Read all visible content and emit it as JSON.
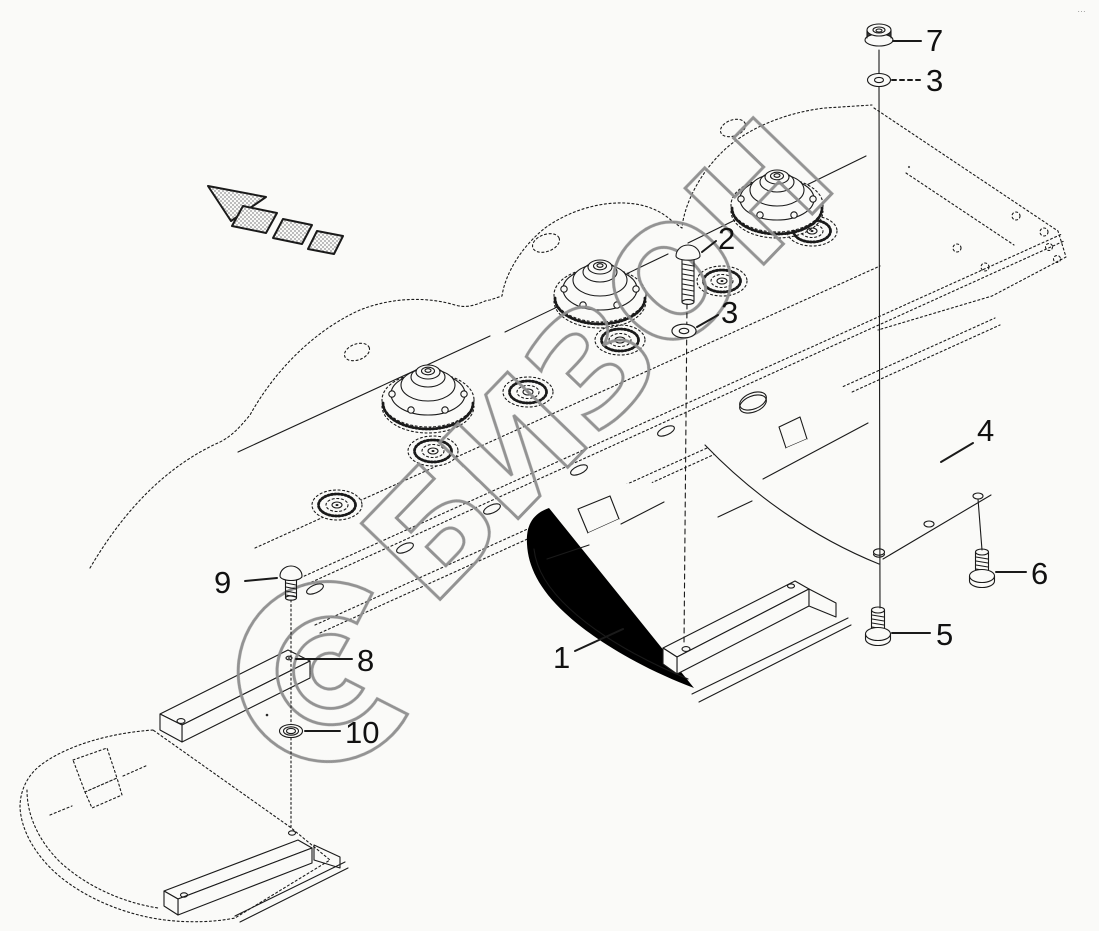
{
  "page": {
    "background": "#fafaf8",
    "ink_color": "#1a1a1a",
    "corner_mark": "…",
    "watermark": {
      "text": "БИЗОН",
      "color": "#8e8e8e"
    }
  },
  "callouts": {
    "nut": "7",
    "washer_top": "3",
    "bolt": "2",
    "washer_mid": "3",
    "plate_right": "4",
    "screw_right_rear": "6",
    "screw_right_front": "5",
    "plate_center": "1",
    "screw_left": "9",
    "wear_bar": "8",
    "washer_bottom": "10"
  }
}
